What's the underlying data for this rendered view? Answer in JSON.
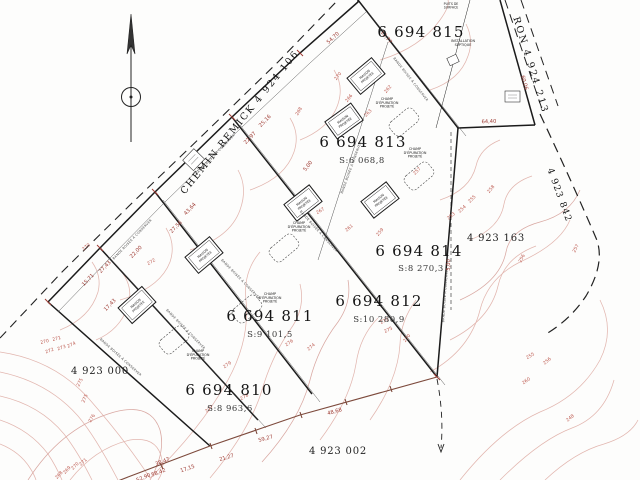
{
  "colors": {
    "contour_line": "#e2b6af",
    "contour_label": "#bd5a50",
    "dimension_red": "#9e3a32",
    "boundary_black": "#1b1b1b",
    "boundary_brown": "#7d4a3c"
  },
  "roads": [
    {
      "id": "chemin-remick",
      "label": "CHEMIN REMICK  4 924 106",
      "x": 242,
      "y": 124,
      "rot": -51,
      "size": 9.5,
      "ls": 1.8
    },
    {
      "id": "heron",
      "label": "RON  4 924 213",
      "x": 528,
      "y": 66,
      "rot": 73,
      "size": 9.5,
      "ls": 2
    },
    {
      "id": "east-boundary",
      "label": "4 923 842",
      "x": 557,
      "y": 196,
      "rot": 70,
      "size": 9,
      "ls": 1.2
    }
  ],
  "parcels": [
    {
      "num": "6 694 815",
      "x": 421,
      "y": 37,
      "area": null,
      "ax": 0,
      "ay": 0
    },
    {
      "num": "6 694 813",
      "x": 363,
      "y": 147,
      "area": "S:6 068,8",
      "ax": 362,
      "ay": 163
    },
    {
      "num": "6 694 814",
      "x": 419,
      "y": 256,
      "area": "S:8 270,3",
      "ax": 421,
      "ay": 271
    },
    {
      "num": "6 694 812",
      "x": 379,
      "y": 306,
      "area": "S:10 280,9",
      "ax": 379,
      "ay": 322
    },
    {
      "num": "6 694 811",
      "x": 270,
      "y": 321,
      "area": "S:9 101,5",
      "ax": 270,
      "ay": 337
    },
    {
      "num": "6 694 810",
      "x": 229,
      "y": 395,
      "area": "S:8 963,6",
      "ax": 230,
      "ay": 411
    }
  ],
  "adjacent_lots": [
    {
      "label": "4 923 000",
      "x": 100,
      "y": 374
    },
    {
      "label": "4 923 002",
      "x": 338,
      "y": 454
    },
    {
      "label": "4 923 163",
      "x": 496,
      "y": 241
    }
  ],
  "dimensions": [
    {
      "v": "17,43",
      "x": 111,
      "y": 306,
      "r": -46
    },
    {
      "v": "15,71",
      "x": 89,
      "y": 281,
      "r": -46
    },
    {
      "v": "27,43",
      "x": 106,
      "y": 268,
      "r": -46
    },
    {
      "v": "22,00",
      "x": 137,
      "y": 253,
      "r": -46
    },
    {
      "v": "27,56",
      "x": 177,
      "y": 228,
      "r": -46
    },
    {
      "v": "43,64",
      "x": 191,
      "y": 210,
      "r": -46
    },
    {
      "v": "22,97",
      "x": 251,
      "y": 139,
      "r": -46
    },
    {
      "v": "25,16",
      "x": 266,
      "y": 122,
      "r": -46
    },
    {
      "v": "54,70",
      "x": 334,
      "y": 39,
      "r": -43
    },
    {
      "v": "12,77",
      "x": 385,
      "y": 38,
      "r": 51
    },
    {
      "v": "60,06",
      "x": 523,
      "y": 83,
      "r": 74
    },
    {
      "v": "64,40",
      "x": 489,
      "y": 123,
      "r": -2
    },
    {
      "v": "5,00",
      "x": 450,
      "y": 265,
      "r": -88
    },
    {
      "v": "5,00",
      "x": 309,
      "y": 167,
      "r": -52
    },
    {
      "v": "38,47",
      "x": 163,
      "y": 463,
      "r": -21
    },
    {
      "v": "58,42",
      "x": 159,
      "y": 474,
      "r": -21
    },
    {
      "v": "52,90",
      "x": 144,
      "y": 479,
      "r": -23
    },
    {
      "v": "17,15",
      "x": 188,
      "y": 470,
      "r": -19
    },
    {
      "v": "21,27",
      "x": 227,
      "y": 459,
      "r": -17
    },
    {
      "v": "59,27",
      "x": 266,
      "y": 440,
      "r": -16
    },
    {
      "v": "48,68",
      "x": 335,
      "y": 413,
      "r": -16
    }
  ],
  "contour_labels": [
    {
      "v": "270",
      "x": 45,
      "y": 343,
      "r": -15
    },
    {
      "v": "271",
      "x": 57,
      "y": 340,
      "r": -15
    },
    {
      "v": "272",
      "x": 50,
      "y": 352,
      "r": -20
    },
    {
      "v": "273",
      "x": 62,
      "y": 349,
      "r": -20
    },
    {
      "v": "274",
      "x": 72,
      "y": 346,
      "r": -25
    },
    {
      "v": "275",
      "x": 81,
      "y": 383,
      "r": -62
    },
    {
      "v": "275",
      "x": 86,
      "y": 399,
      "r": -66
    },
    {
      "v": "276",
      "x": 93,
      "y": 419,
      "r": -60
    },
    {
      "v": "268",
      "x": 60,
      "y": 476,
      "r": -48
    },
    {
      "v": "269",
      "x": 68,
      "y": 471,
      "r": -48
    },
    {
      "v": "270",
      "x": 76,
      "y": 467,
      "r": -45
    },
    {
      "v": "271",
      "x": 84,
      "y": 463,
      "r": -42
    },
    {
      "v": "279",
      "x": 228,
      "y": 366,
      "r": -35
    },
    {
      "v": "277",
      "x": 210,
      "y": 410,
      "r": -40
    },
    {
      "v": "278",
      "x": 245,
      "y": 398,
      "r": -30
    },
    {
      "v": "276",
      "x": 290,
      "y": 344,
      "r": -35
    },
    {
      "v": "273",
      "x": 385,
      "y": 322,
      "r": -28
    },
    {
      "v": "275",
      "x": 389,
      "y": 331,
      "r": -28
    },
    {
      "v": "274",
      "x": 312,
      "y": 348,
      "r": -40
    },
    {
      "v": "270",
      "x": 408,
      "y": 339,
      "r": -52
    },
    {
      "v": "268",
      "x": 300,
      "y": 112,
      "r": -60
    },
    {
      "v": "263",
      "x": 369,
      "y": 114,
      "r": -45
    },
    {
      "v": "267",
      "x": 321,
      "y": 212,
      "r": -30
    },
    {
      "v": "261",
      "x": 350,
      "y": 229,
      "r": -40
    },
    {
      "v": "270",
      "x": 339,
      "y": 77,
      "r": -52
    },
    {
      "v": "266",
      "x": 350,
      "y": 99,
      "r": -52
    },
    {
      "v": "262",
      "x": 389,
      "y": 90,
      "r": -50
    },
    {
      "v": "257",
      "x": 418,
      "y": 172,
      "r": -45
    },
    {
      "v": "259",
      "x": 381,
      "y": 233,
      "r": -50
    },
    {
      "v": "253",
      "x": 452,
      "y": 217,
      "r": -40
    },
    {
      "v": "254",
      "x": 463,
      "y": 210,
      "r": -42
    },
    {
      "v": "255",
      "x": 473,
      "y": 200,
      "r": -45
    },
    {
      "v": "258",
      "x": 492,
      "y": 190,
      "r": -50
    },
    {
      "v": "256",
      "x": 523,
      "y": 259,
      "r": -62
    },
    {
      "v": "257",
      "x": 577,
      "y": 249,
      "r": -62
    },
    {
      "v": "255",
      "x": 531,
      "y": 357,
      "r": -30
    },
    {
      "v": "256",
      "x": 548,
      "y": 362,
      "r": -40
    },
    {
      "v": "260",
      "x": 527,
      "y": 382,
      "r": -35
    },
    {
      "v": "248",
      "x": 571,
      "y": 419,
      "r": -40
    },
    {
      "v": "272",
      "x": 152,
      "y": 263,
      "r": -30
    },
    {
      "v": "270",
      "x": 87,
      "y": 248,
      "r": -40
    }
  ],
  "annotations": {
    "maison": {
      "lines": [
        "MAISON",
        "PROJETÉE"
      ]
    },
    "champ": {
      "lines": [
        "CHAMP",
        "D'ÉPURATION",
        "PROJETÉ"
      ],
      "items": [
        {
          "tx": 387,
          "ty": 100,
          "rx": 404,
          "ry": 122
        },
        {
          "tx": 415,
          "ty": 150,
          "rx": 419,
          "ry": 176
        },
        {
          "tx": 299,
          "ty": 224,
          "rx": 284,
          "ry": 248
        },
        {
          "tx": 270,
          "ty": 295,
          "rx": 247,
          "ry": 309
        },
        {
          "tx": 198,
          "ty": 352,
          "rx": 174,
          "ry": 340
        }
      ]
    },
    "septique": {
      "lines": [
        "INSTALLATION",
        "SEPTIQUE"
      ],
      "x": 463,
      "y": 42
    },
    "puits": {
      "lines": [
        "PUITS DE",
        "SURFACE"
      ],
      "x": 451,
      "y": 5
    },
    "bande": {
      "label": "BANDE BOISÉE À CONSERVER",
      "positions": [
        {
          "x": 216,
          "y": 155,
          "r": -46
        },
        {
          "x": 133,
          "y": 240,
          "r": -46
        },
        {
          "x": 120,
          "y": 358,
          "r": 42
        },
        {
          "x": 185,
          "y": 330,
          "r": 46
        },
        {
          "x": 240,
          "y": 280,
          "r": 46
        },
        {
          "x": 318,
          "y": 232,
          "r": 48
        },
        {
          "x": 352,
          "y": 168,
          "r": -70
        },
        {
          "x": 410,
          "y": 80,
          "r": 52
        },
        {
          "x": 446,
          "y": 295,
          "r": -86
        }
      ]
    }
  },
  "houses": [
    {
      "x": 366,
      "y": 76,
      "r": -40
    },
    {
      "x": 344,
      "y": 121,
      "r": -36
    },
    {
      "x": 303,
      "y": 203,
      "r": -38
    },
    {
      "x": 204,
      "y": 255,
      "r": -40
    },
    {
      "x": 137,
      "y": 305,
      "r": -42
    },
    {
      "x": 380,
      "y": 200,
      "r": -38
    }
  ]
}
